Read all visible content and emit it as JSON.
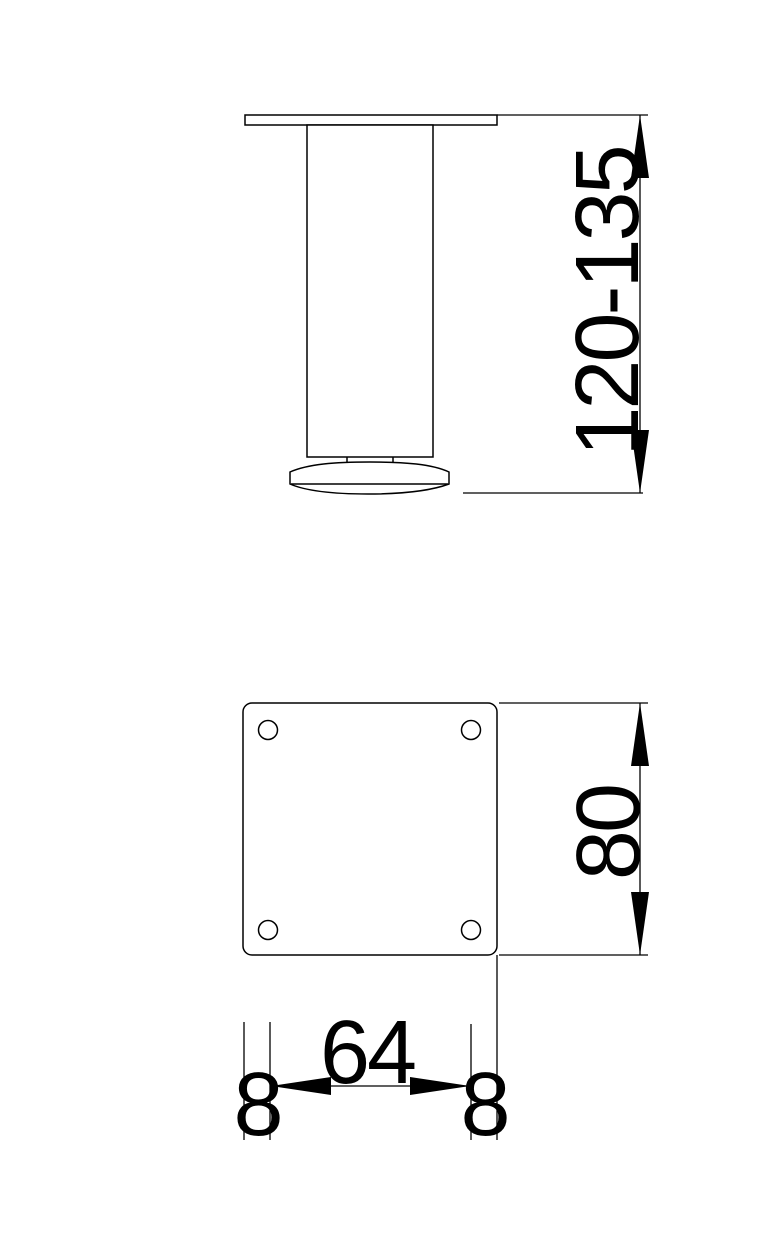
{
  "labels": {
    "height_range": "120-135",
    "plate_size": "80",
    "hole_spacing": "64",
    "edge_offset_left": "8",
    "edge_offset_right": "8"
  },
  "style": {
    "line_color": "#000000",
    "text_color": "#000000",
    "background_color": "#ffffff"
  }
}
